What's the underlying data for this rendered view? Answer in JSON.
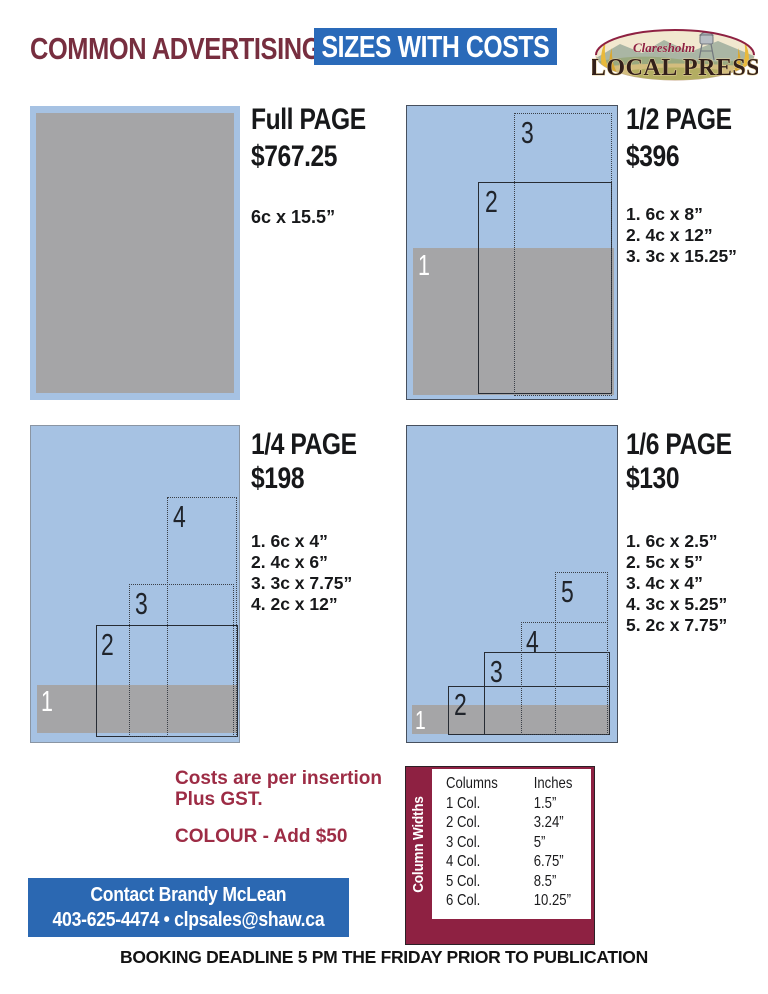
{
  "header": {
    "title_left": "COMMON ADVERTISING",
    "title_right": "SIZES WITH COSTS"
  },
  "logo": {
    "town": "Claresholm",
    "name": "LOCAL PRESS"
  },
  "panels": [
    {
      "title": "Full PAGE",
      "price": "$767.25",
      "sizes": [
        "6c x 15.5”"
      ],
      "labels": []
    },
    {
      "title": "1/2 PAGE",
      "price": "$396",
      "sizes": [
        "1. 6c x 8”",
        "2. 4c x 12”",
        "3. 3c x 15.25”"
      ],
      "labels": [
        "1",
        "2",
        "3"
      ]
    },
    {
      "title": "1/4 PAGE",
      "price": "$198",
      "sizes": [
        "1. 6c x 4”",
        "2. 4c x 6”",
        "3. 3c x 7.75”",
        "4. 2c x 12”"
      ],
      "labels": [
        "1",
        "2",
        "3",
        "4"
      ]
    },
    {
      "title": "1/6 PAGE",
      "price": "$130",
      "sizes": [
        "1. 6c x 2.5”",
        "2. 5c x 5”",
        "3. 4c x 4”",
        "4. 3c x 5.25”",
        "5. 2c x 7.75”"
      ],
      "labels": [
        "1",
        "2",
        "3",
        "4",
        "5"
      ]
    }
  ],
  "notes": {
    "line1": "Costs are per insertion",
    "line2": "Plus GST.",
    "colour": "COLOUR - Add $50"
  },
  "contact": {
    "line1": "Contact Brandy McLean",
    "line2": "403-625-4474 • clpsales@shaw.ca"
  },
  "column_widths": {
    "side_label": "Column Widths",
    "headers": [
      "Columns",
      "Inches"
    ],
    "rows": [
      [
        "1 Col.",
        "1.5”"
      ],
      [
        "2 Col.",
        "3.24”"
      ],
      [
        "3 Col.",
        "5”"
      ],
      [
        "4 Col.",
        "6.75”"
      ],
      [
        "5 Col.",
        "8.5”"
      ],
      [
        "6 Col.",
        "10.25”"
      ]
    ]
  },
  "footer": "BOOKING DEADLINE 5 PM THE FRIDAY PRIOR TO PUBLICATION",
  "colors": {
    "maroon_heading": "#772e3f",
    "maroon_notes": "#9d2c45",
    "maroon_box": "#8e2142",
    "blue_header": "#2a6ab9",
    "blue_contact": "#2b68b2",
    "panel_blue": "#a6c2e3",
    "panel_gray": "#a5a5a7"
  }
}
